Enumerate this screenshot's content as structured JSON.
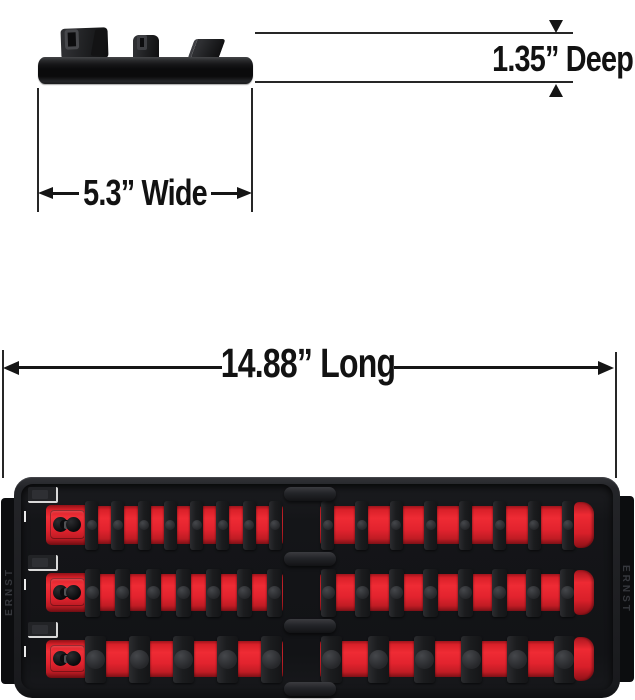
{
  "labels": {
    "deep": "1.35” Deep",
    "wide": "5.3” Wide",
    "long": "14.88” Long"
  },
  "colors": {
    "accent_red": "#e2232e",
    "ink": "#141414",
    "tray_black": "#1e1f22"
  },
  "tray": {
    "brand_left": "ERNST",
    "brand_right": "ERNST",
    "rows": [
      {
        "name": "socket-rail-top",
        "clips_left": 8,
        "clips_right": 8
      },
      {
        "name": "socket-rail-middle",
        "clips_left": 7,
        "clips_right": 8
      },
      {
        "name": "socket-rail-bottom",
        "clips_left": 5,
        "clips_right": 6
      }
    ]
  }
}
